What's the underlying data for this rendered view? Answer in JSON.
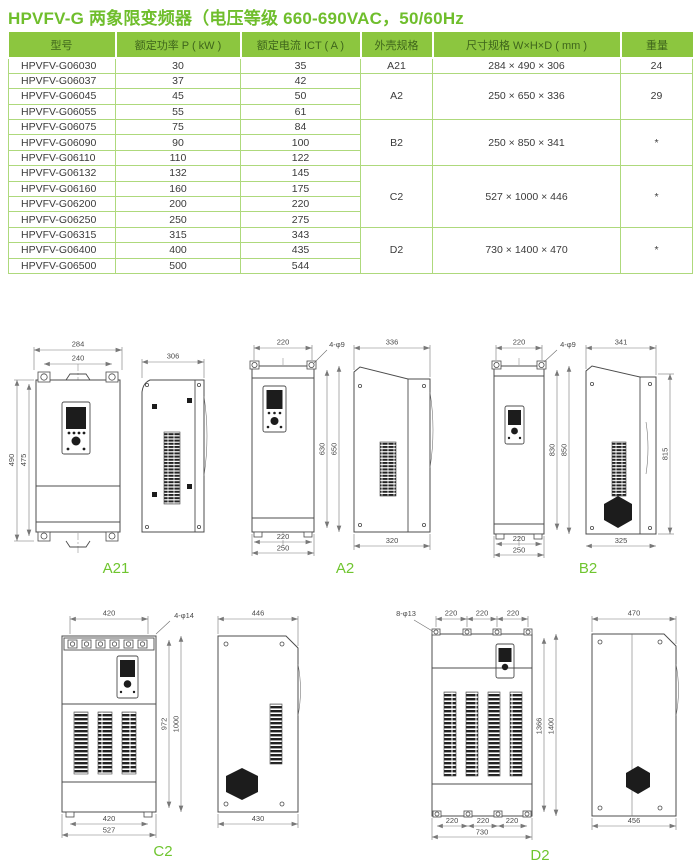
{
  "page": {
    "title": "HPVFV-G 两象限变频器（电压等级 660-690VAC，50/60Hz"
  },
  "table": {
    "headers": [
      "型号",
      "额定功率 P ( kW )",
      "额定电流 ICT ( A )",
      "外壳规格",
      "尺寸规格 W×H×D ( mm )",
      "重量"
    ],
    "rows": [
      {
        "model": "HPVFV-G06030",
        "power": "30",
        "current": "35",
        "frame": "A21",
        "size": "284 × 490 × 306",
        "weight": "24"
      },
      {
        "model": "HPVFV-G06037",
        "power": "37",
        "current": "42",
        "frame": "A2",
        "size": "250 × 650 × 336",
        "weight": "29"
      },
      {
        "model": "HPVFV-G06045",
        "power": "45",
        "current": "50"
      },
      {
        "model": "HPVFV-G06055",
        "power": "55",
        "current": "61"
      },
      {
        "model": "HPVFV-G06075",
        "power": "75",
        "current": "84",
        "frame": "B2",
        "size": "250 × 850 × 341",
        "weight": "*"
      },
      {
        "model": "HPVFV-G06090",
        "power": "90",
        "current": "100"
      },
      {
        "model": "HPVFV-G06110",
        "power": "110",
        "current": "122"
      },
      {
        "model": "HPVFV-G06132",
        "power": "132",
        "current": "145",
        "frame": "C2",
        "size": "527 × 1000 × 446",
        "weight": "*"
      },
      {
        "model": "HPVFV-G06160",
        "power": "160",
        "current": "175"
      },
      {
        "model": "HPVFV-G06200",
        "power": "200",
        "current": "220"
      },
      {
        "model": "HPVFV-G06250",
        "power": "250",
        "current": "275"
      },
      {
        "model": "HPVFV-G06315",
        "power": "315",
        "current": "343",
        "frame": "D2",
        "size": "730 × 1400 × 470",
        "weight": "*"
      },
      {
        "model": "HPVFV-G06400",
        "power": "400",
        "current": "435"
      },
      {
        "model": "HPVFV-G06500",
        "power": "500",
        "current": "544"
      }
    ]
  },
  "drawings": {
    "a21": {
      "label": "A21",
      "top_outer": "284",
      "top_inner": "240",
      "height_outer": "490",
      "height_inner": "475",
      "side_depth": "306"
    },
    "a2": {
      "label": "A2",
      "top": "220",
      "holes": "4-φ9",
      "height_inner": "630",
      "height_outer": "650",
      "bottom_inner": "220",
      "bottom_outer": "250",
      "side_top": "336",
      "side_bottom": "320"
    },
    "b2": {
      "label": "B2",
      "top": "220",
      "holes": "4-φ9",
      "height_inner": "830",
      "height_outer": "850",
      "bottom_inner": "220",
      "bottom_outer": "250",
      "side_top": "341",
      "side_height": "815",
      "side_bottom": "325"
    },
    "c2": {
      "label": "C2",
      "top": "420",
      "holes": "4-φ14",
      "height_inner": "972",
      "height_outer": "1000",
      "bottom_inner": "420",
      "bottom_outer": "527",
      "side_top": "446",
      "side_bottom": "430"
    },
    "d2": {
      "label": "D2",
      "holes": "8-φ13",
      "top1": "220",
      "top2": "220",
      "top3": "220",
      "height_inner": "1366",
      "height_outer": "1400",
      "bottom1": "220",
      "bottom2": "220",
      "bottom3": "220",
      "bottom_total": "730",
      "side_top": "470",
      "side_bottom": "456"
    }
  },
  "colors": {
    "accent_green": "#6fbe2c",
    "header_bg": "#8cc63f",
    "header_text": "#3e651b",
    "table_border": "#aed97c"
  }
}
